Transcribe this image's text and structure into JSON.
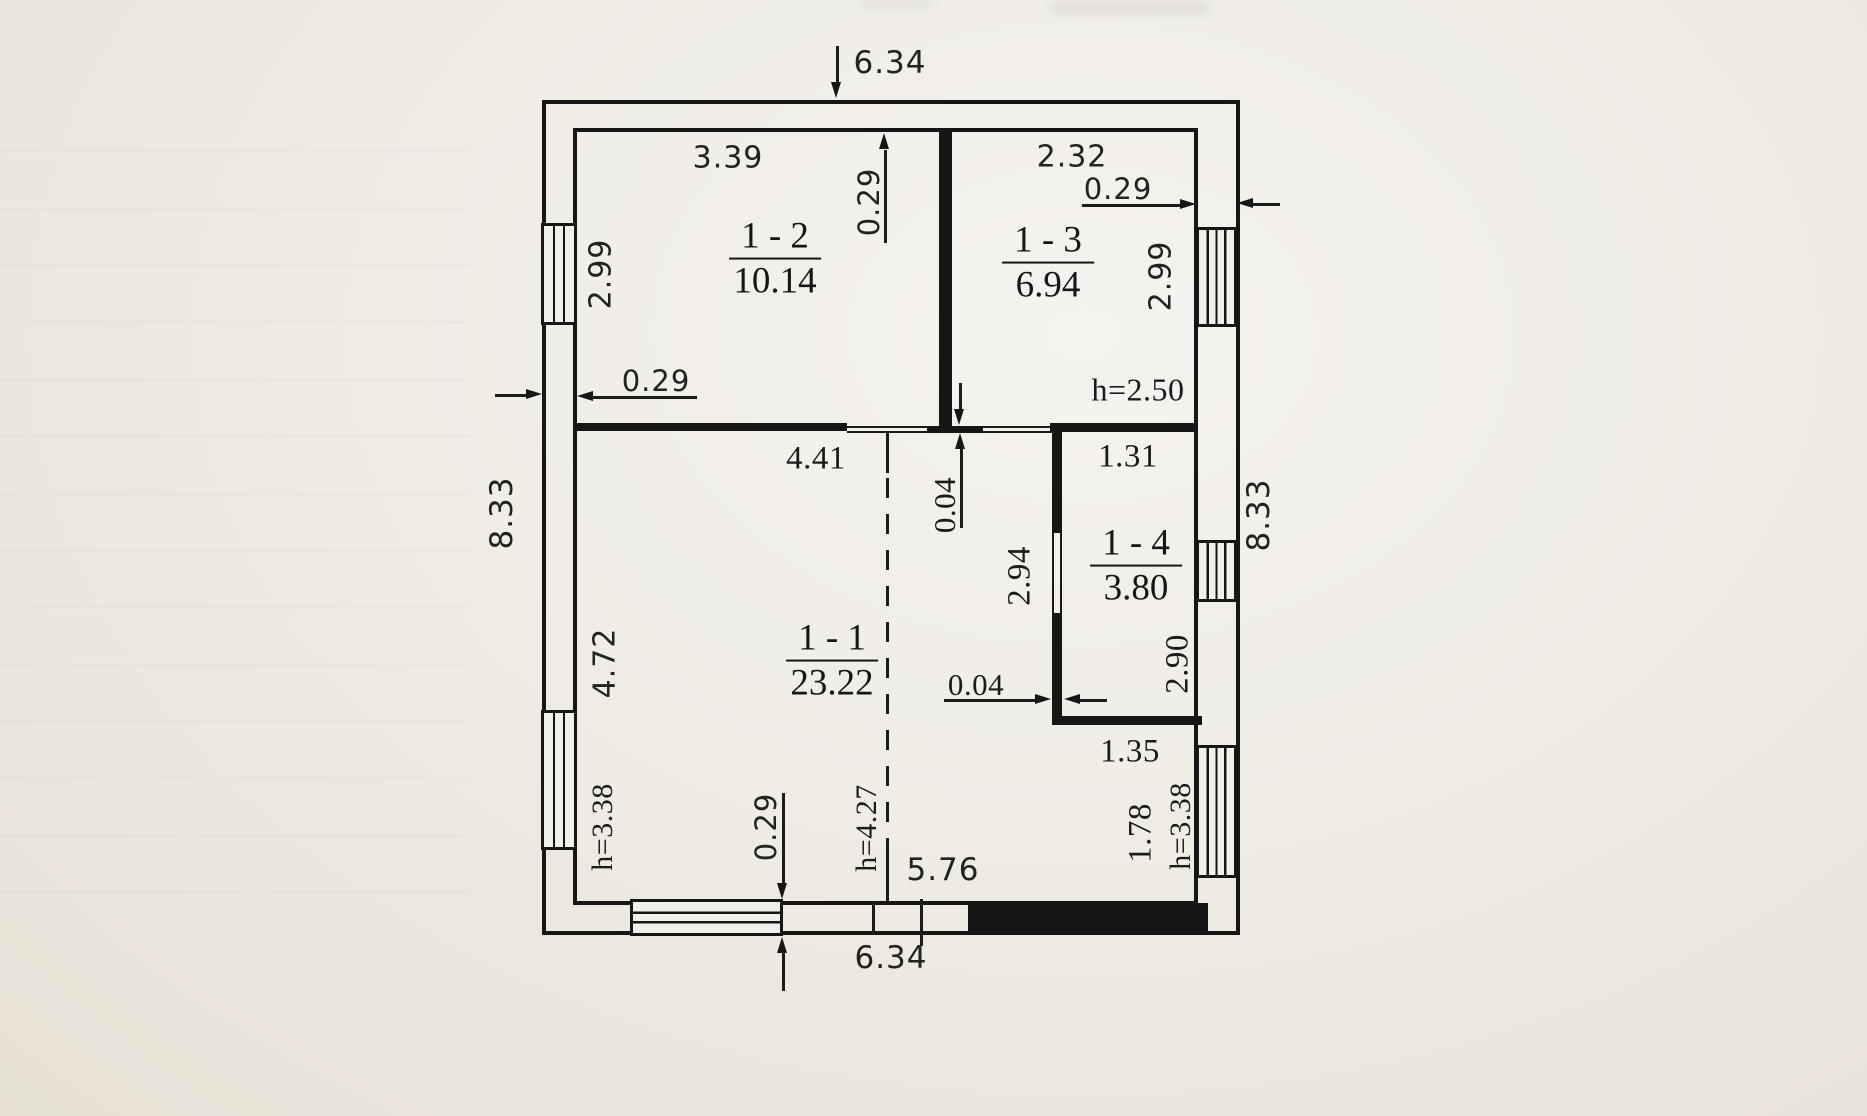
{
  "document": {
    "type": "floor-plan-scan",
    "paper_color": "#efece6",
    "ink_color": "#161616"
  },
  "rooms": [
    {
      "label": "1 - 1",
      "area": "23.22"
    },
    {
      "label": "1 - 2",
      "area": "10.14"
    },
    {
      "label": "1 - 3",
      "area": "6.94"
    },
    {
      "label": "1 - 4",
      "area": "3.80"
    }
  ],
  "dims": {
    "top_width": "6.34",
    "r12_width": "3.39",
    "r13_width": "2.32",
    "wall_right_t": "0.29",
    "wall_top_t": "0.29",
    "wall_left_t": "0.29",
    "wall_bottom_t": "0.29",
    "left_h_upper": "2.99",
    "right_h_upper": "2.99",
    "left_h_total": "8.33",
    "right_h_total": "8.33",
    "left_h_lower": "4.72",
    "r11_width": "4.41",
    "r14_w_top": "1.31",
    "r14_h": "2.94",
    "r14_w_bottom": "1.35",
    "corridor_h": "2.90",
    "corridor_w": "1.78",
    "partition_t_v": "0.04",
    "partition_t_h": "0.04",
    "height_r13": "h=2.50",
    "height_left": "h=3.38",
    "height_center": "h=4.27",
    "height_right": "h=3.38",
    "inner_width": "5.76",
    "bottom_width": "6.34"
  }
}
